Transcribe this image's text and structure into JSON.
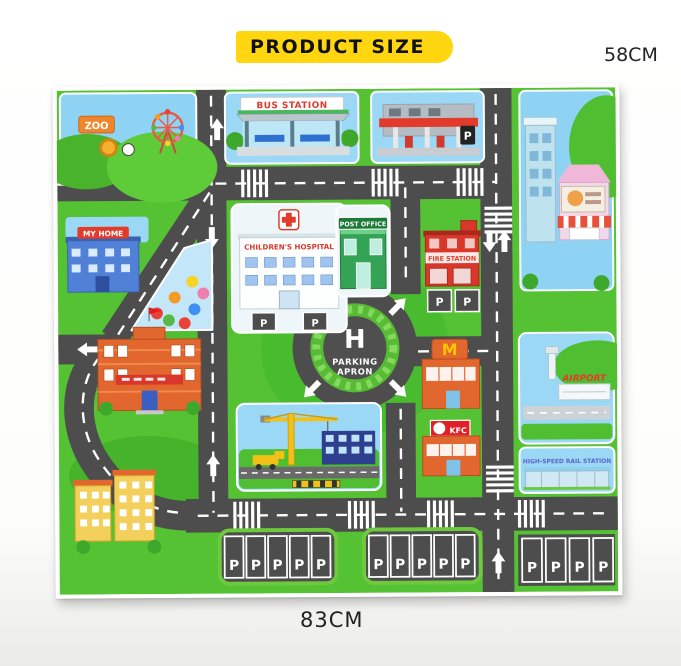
{
  "header": {
    "badge": "PRODUCT SIZE"
  },
  "dimensions": {
    "height": "58CM",
    "width": "83CM"
  },
  "mat": {
    "labels": {
      "zoo": "ZOO",
      "bus_station": "BUS STATION",
      "my_home": "MY HOME",
      "childrens_hospital": "CHILDREN'S HOSPITAL",
      "post_office": "POST OFFICE",
      "fire_station": "FIRE STATION",
      "helipad": "H",
      "parking_apron_line1": "PARKING",
      "parking_apron_line2": "APRON",
      "mcdonalds_sign": "M",
      "kfc": "KFC",
      "airport": "AIRPORT",
      "high_speed_rail_station": "HIGH-SPEED RAIL STATION",
      "parking_spot": "P"
    },
    "parking_counts": {
      "hospital_spots": 2,
      "fire_station_spots": 2,
      "gas_station_spots": 1,
      "bottom_left_lot": 5,
      "bottom_center_lot": 5,
      "bottom_right_lot": 4
    },
    "balloon_colors": [
      "#e84338",
      "#f59a23",
      "#f5d327",
      "#57b947",
      "#3f8ef3",
      "#ef7fae",
      "#e84338"
    ],
    "colors": {
      "road": "#4d4d4d",
      "road_line": "#ffffff",
      "grass": "#55c233",
      "sky": "#9bd8f6",
      "badge_yellow": "#ffd60f",
      "sign_red": "#e23b2c",
      "roundabout_green": "#57bb35",
      "building_orange": "#e2672f",
      "kfc_red": "#e01f26",
      "mcdonalds_yellow": "#ffc600",
      "post_office_green": "#35a356",
      "rail_text_blue": "#5b63c8"
    }
  }
}
